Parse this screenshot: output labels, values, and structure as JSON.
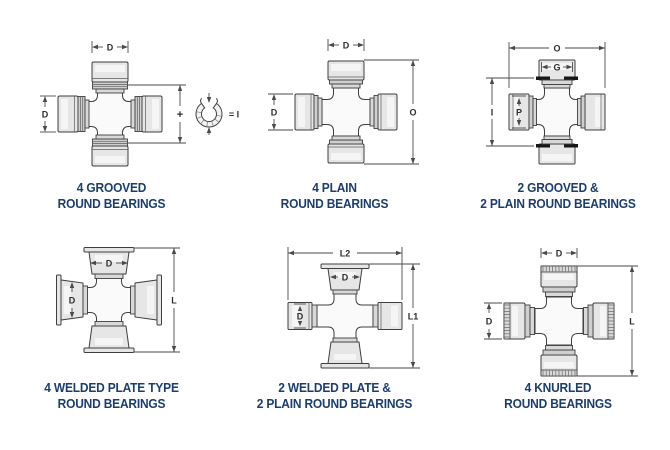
{
  "colors": {
    "background": "#ffffff",
    "caption_text": "#1c3e6e",
    "drawing_line": "#3f3f3f",
    "dimension_line": "#4a4a4a",
    "dimension_text": "#2e2e2e",
    "cap_fill": "#e6e6e6",
    "snap_ring_groove": "#161616"
  },
  "diagrams": [
    {
      "id": "4-grooved",
      "caption": [
        "4 GROOVED",
        "ROUND BEARINGS"
      ],
      "dims": {
        "top": "D",
        "left": "D",
        "mid_plus": "+",
        "snap_ring_equals": "= I"
      }
    },
    {
      "id": "4-plain",
      "caption": [
        "4 PLAIN",
        "ROUND BEARINGS"
      ],
      "dims": {
        "top": "D",
        "left": "D",
        "right": "O"
      }
    },
    {
      "id": "2-grooved-2-plain",
      "caption": [
        "2 GROOVED &",
        "2 PLAIN ROUND BEARINGS"
      ],
      "dims": {
        "top": "O",
        "cap_top": "G",
        "left": "I",
        "cap_left": "P"
      }
    },
    {
      "id": "4-welded-plate",
      "caption": [
        "4 WELDED PLATE TYPE",
        "ROUND BEARINGS"
      ],
      "dims": {
        "cap_top": "D",
        "cap_left": "D",
        "right": "L"
      }
    },
    {
      "id": "2-welded-2-plain",
      "caption": [
        "2 WELDED PLATE &",
        "2 PLAIN ROUND BEARINGS"
      ],
      "dims": {
        "top": "L2",
        "cap_top": "D",
        "cap_left": "D",
        "right": "L1"
      }
    },
    {
      "id": "4-knurled",
      "caption": [
        "4 KNURLED",
        "ROUND BEARINGS"
      ],
      "dims": {
        "top": "D",
        "left": "D",
        "right": "L"
      }
    }
  ]
}
